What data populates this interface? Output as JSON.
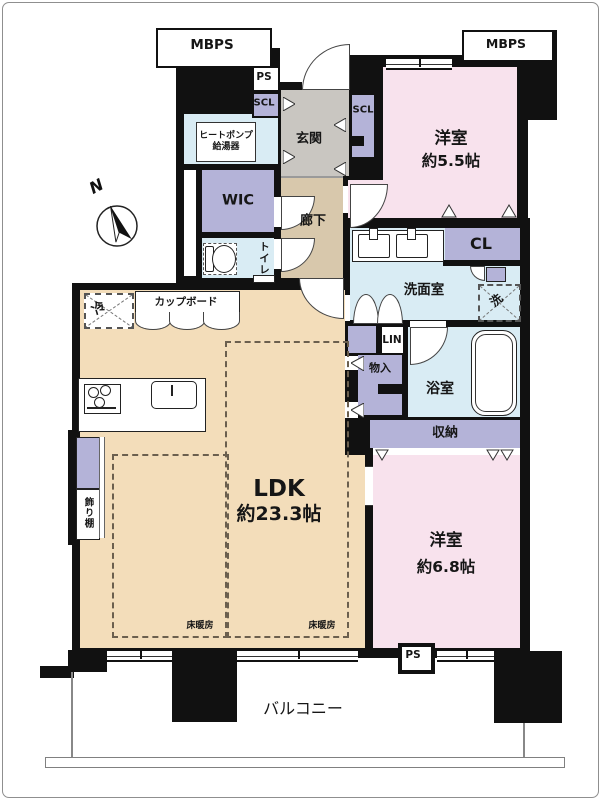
{
  "floorplan": {
    "shafts": {
      "mbps_left": "MBPS",
      "mbps_right": "MBPS",
      "ps_top": "PS",
      "ps_bottom": "PS"
    },
    "entrance": {
      "label": "玄関",
      "scl_left": "SCL",
      "scl_right": "SCL"
    },
    "equipment": {
      "heat_pump_line1": "ヒートポンプ",
      "heat_pump_line2": "給湯器",
      "cupboard": "カップボード",
      "fridge": "冷",
      "washer": "洗",
      "floor_heating": "床暖房"
    },
    "rooms": {
      "wic": "WIC",
      "toilet": "トイレ",
      "hallway": "廊下",
      "western_room_1": {
        "name": "洋室",
        "area": "約5.5帖"
      },
      "western_room_2": {
        "name": "洋室",
        "area": "約6.8帖"
      },
      "ldk": {
        "name": "LDK",
        "area": "約23.3帖"
      },
      "washroom": "洗面室",
      "bathroom": "浴室",
      "balcony": "バルコニー"
    },
    "storage": {
      "cl": "CL",
      "linen": "LIN",
      "monoire": "物入",
      "shuno": "収納",
      "kazaridana": "飾り棚"
    },
    "compass": {
      "north": "N"
    },
    "colors": {
      "wall": "#111111",
      "western_room": "#f8e2ed",
      "ldk": "#f3ddba",
      "hallway": "#d8c8ac",
      "entrance": "#c9c6c1",
      "wet_area": "#d9ecf4",
      "closet": "#b4b3d8"
    }
  }
}
